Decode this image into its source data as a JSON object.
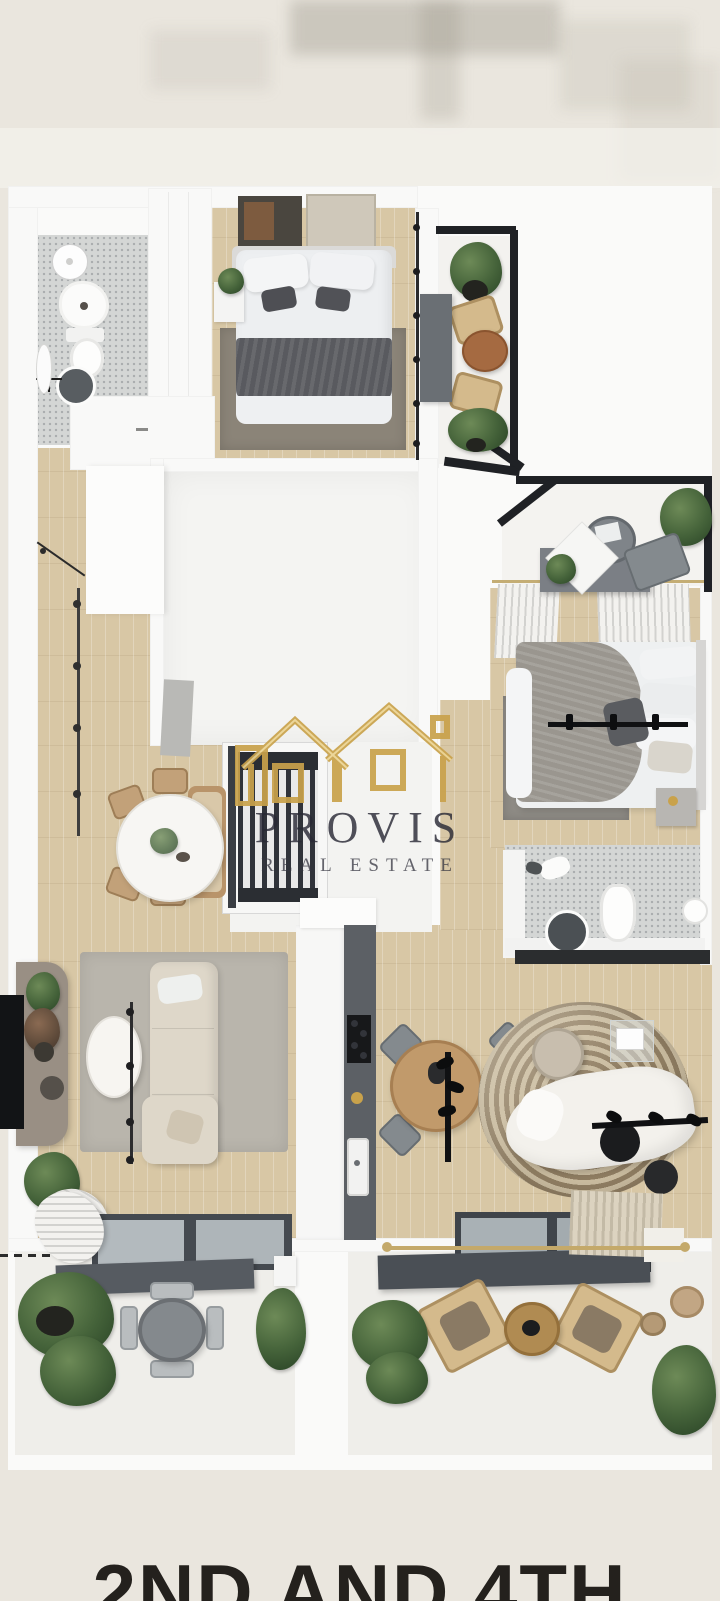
{
  "page": {
    "background": "#eae6de",
    "render_backdrop": "#fafaf9"
  },
  "watermark": {
    "brand": "PROVIS",
    "tagline": "REAL ESTATE",
    "logo": "gold-houses-outline",
    "logo_color": "#c9a24b",
    "logo_highlight": "#ecd492",
    "text_color": "#2a2a34"
  },
  "caption": {
    "text": "2ND AND 4TH",
    "color": "#24211d",
    "cropped": "bottom edge of frame"
  },
  "palette": {
    "wall": "#f9f9f8",
    "wood_floor": "#d8c7a5",
    "mosaic_tile": "#d4d6d5",
    "railing_black": "#1f2125",
    "kitchen_counter": "#5c6065",
    "stairs_tread": "#2e3136",
    "rug_gray": "#b9b5ac",
    "rug_stripe_dark": "#8f7d62",
    "rug_stripe_light": "#c9bb9f",
    "sofa_beige": "#ded7c9",
    "sofa_white": "#f3f1ec",
    "lounge_tan": "#d4ba8c",
    "plant_green": "#45633a",
    "accent_gold": "#c9a24b"
  },
  "floorplan": {
    "type": "3d-top-down-apartment-render",
    "rooms": [
      {
        "id": "bathroom-1",
        "position": "top-left",
        "floor": "#d4d6d5"
      },
      {
        "id": "bedroom-1",
        "position": "top-center",
        "floor": "#d8c7a5"
      },
      {
        "id": "balcony-1",
        "position": "top-right",
        "floor": "#f3f2ef"
      },
      {
        "id": "central-room",
        "position": "middle",
        "floor": "#f4f4f2"
      },
      {
        "id": "hallway-dining",
        "position": "middle-left",
        "floor": "#d8c7a5"
      },
      {
        "id": "staircase",
        "position": "center",
        "treads": "#2e3136"
      },
      {
        "id": "balcony-2",
        "position": "right-middle",
        "floor": "#f4f3f0"
      },
      {
        "id": "bedroom-2",
        "position": "right",
        "floor": "#d8c7a5"
      },
      {
        "id": "bathroom-2",
        "position": "right-lower",
        "floor": "#c9cccd"
      },
      {
        "id": "living-room",
        "position": "bottom-left",
        "rug": "#b9b5ac",
        "sofa": "#ded7c9"
      },
      {
        "id": "kitchen",
        "position": "bottom-center",
        "counter": "#5c6065"
      },
      {
        "id": "family-lounge",
        "position": "bottom-right",
        "rug_stripes": [
          "#8f7d62",
          "#c9bb9f"
        ],
        "sofa": "#f3f1ec"
      },
      {
        "id": "balcony-3",
        "position": "bottom-left",
        "floor": "#efeeea"
      },
      {
        "id": "balcony-4",
        "position": "bottom-right",
        "floor": "#efeeea"
      }
    ]
  }
}
